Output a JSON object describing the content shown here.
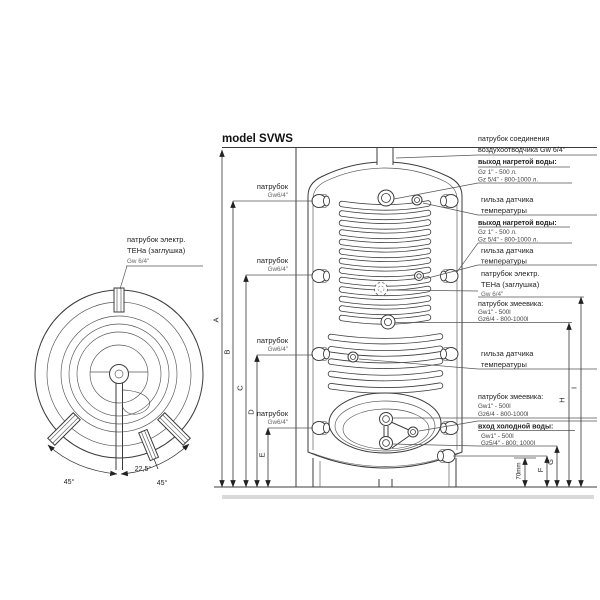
{
  "title": "model SVWS",
  "top_view": {
    "heater_label": {
      "line1": "патрубок электр.",
      "line2": "ТЕНа (заглушка)",
      "line3": "Gw 6/4\""
    },
    "angles": {
      "left": "45°",
      "middle": "22,5°",
      "right": "45°"
    }
  },
  "left_labels": [
    {
      "name": "патрубок",
      "size": "Gw6/4\""
    },
    {
      "name": "патрубок",
      "size": "Gw6/4\""
    },
    {
      "name": "патрубок",
      "size": "Gw6/4\""
    },
    {
      "name": "патрубок",
      "size": "Gw6/4\""
    }
  ],
  "right_labels": {
    "air_vent": {
      "line1": "патрубок соединения",
      "line2": "воздухоотводчика Gw 6/4\""
    },
    "hot_water_top": {
      "heading": "выход нагретой воды:",
      "size1": "Gz 1\" - 500 л.",
      "size2": "Gz 5/4\" - 800-1000 л."
    },
    "sensor_sleeve_1": {
      "line1": "гильза датчика",
      "line2": "температуры"
    },
    "hot_water_mid": {
      "heading": "выход нагретой воды:",
      "size1": "Gz 1\" - 500 л.",
      "size2": "Gz 5/4\" - 800-1000 л."
    },
    "sensor_sleeve_2": {
      "line1": "гильза датчика",
      "line2": "температуры"
    },
    "electric_heater": {
      "line1": "патрубок электр.",
      "line2": "ТЕНа (заглушка)",
      "line3": "Gw 6/4\""
    },
    "coil_upper": {
      "heading": "патрубок змеевика:",
      "size1": "Gw1\" - 500l",
      "size2": "Gz6/4 - 800-1000l"
    },
    "sensor_sleeve_3": {
      "line1": "гильза датчика",
      "line2": "температуры"
    },
    "coil_lower": {
      "heading": "патрубок змеевика:",
      "size1": "Gw1\" - 500l",
      "size2": "Gz6/4 - 800-1000l"
    },
    "cold_water_inlet": {
      "heading": "вход холодной воды:",
      "size1": "Gw1\" - 500l",
      "size2": "Gz5/4\" - 800; 1000l"
    }
  },
  "dimensions": {
    "A": "A",
    "B": "B",
    "C": "C",
    "D": "D",
    "E": "E",
    "F": "F",
    "G": "G",
    "H": "H",
    "I": "I",
    "offset": "70mm"
  }
}
